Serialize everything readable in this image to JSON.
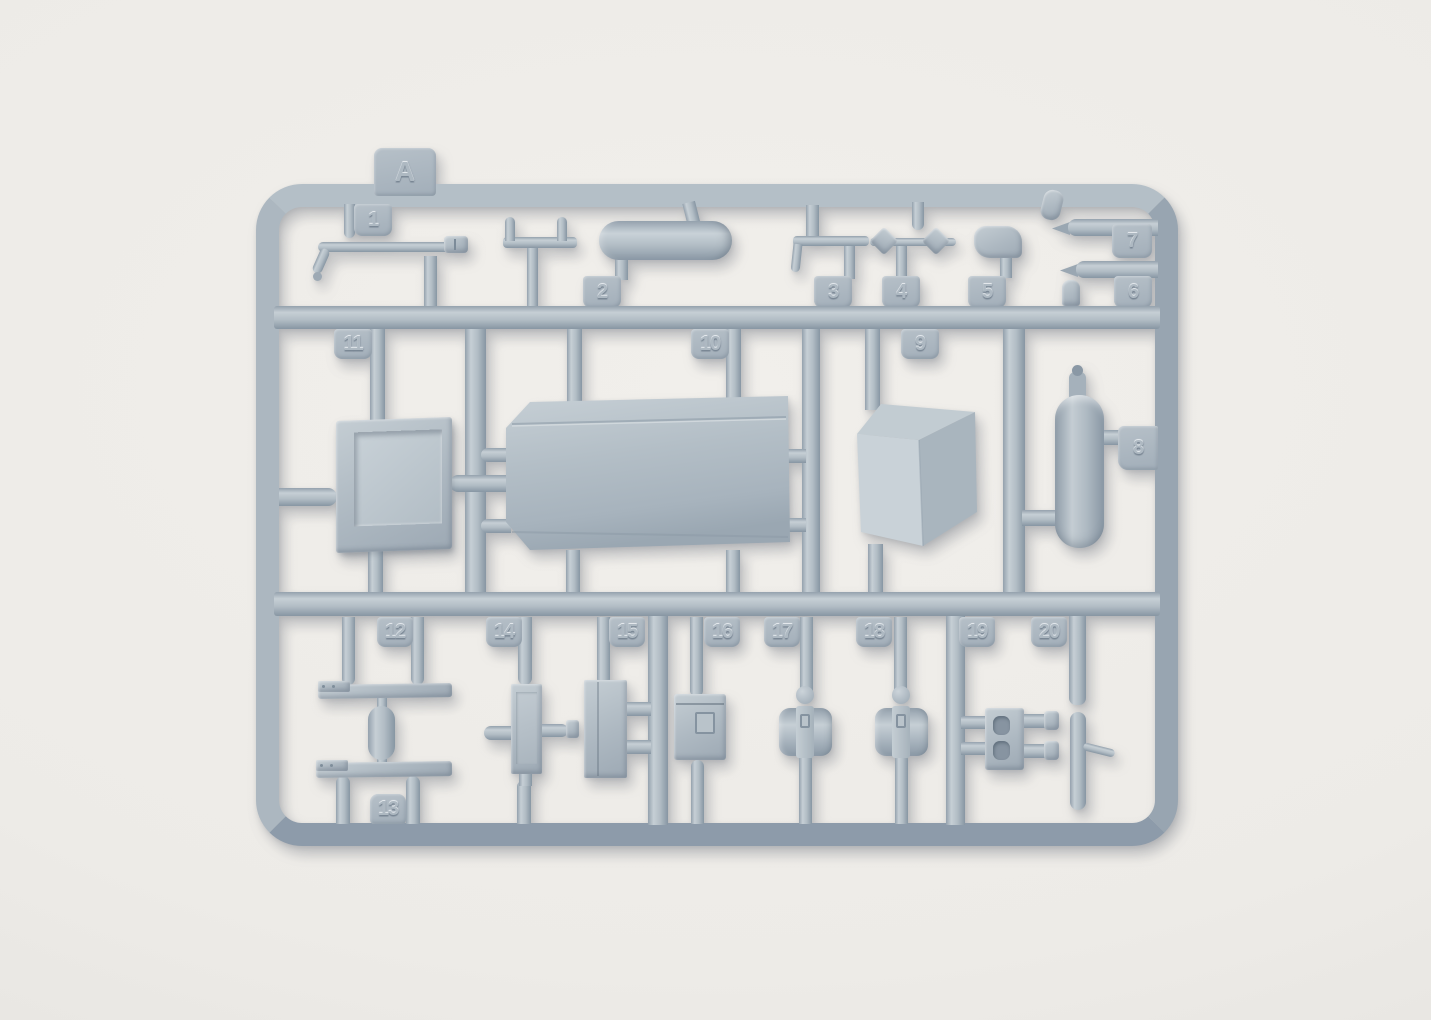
{
  "scene": {
    "description": "Photograph of a light grey injection-moulded plastic model-kit sprue (runner A) lying on a white surface",
    "background_color": "#edebe7",
    "plastic_color": "#aab4bd",
    "plastic_highlight": "#c6cfd5",
    "plastic_shadow": "#8796a3"
  },
  "sprue": {
    "letter_tab": "A",
    "tab_numbers": [
      "1",
      "2",
      "3",
      "4",
      "5",
      "6",
      "7",
      "8",
      "9",
      "10",
      "11",
      "12",
      "13",
      "14",
      "15",
      "16",
      "17",
      "18",
      "19",
      "20"
    ],
    "parts": [
      {
        "number": "1",
        "shape": "long tow-rod with hooked end"
      },
      {
        "number": "2",
        "shape": "horizontal cylinder tank"
      },
      {
        "number": "3",
        "shape": "L-shaped bracket"
      },
      {
        "number": "4",
        "shape": "axle with bow-tie paddles"
      },
      {
        "number": "5",
        "shape": "curved hook block"
      },
      {
        "number": "6",
        "shape": "small pointed barrel"
      },
      {
        "number": "7",
        "shape": "small pointed barrel"
      },
      {
        "number": "8",
        "shape": "vertical cylinder with filler cap"
      },
      {
        "number": "9",
        "shape": "faceted angular cover"
      },
      {
        "number": "10",
        "shape": "large bevelled flat panel"
      },
      {
        "number": "11",
        "shape": "rectangular open tray"
      },
      {
        "number": "12",
        "shape": "flat blade strip with end plate"
      },
      {
        "number": "13",
        "shape": "flat blade strip with end plate"
      },
      {
        "number": "14",
        "shape": "plate with side pegs"
      },
      {
        "number": "15",
        "shape": "rectangular block"
      },
      {
        "number": "16",
        "shape": "stowage box with latch"
      },
      {
        "number": "17",
        "shape": "strapped drum"
      },
      {
        "number": "18",
        "shape": "strapped drum"
      },
      {
        "number": "19",
        "shape": "slotted bracket with twin pegs"
      },
      {
        "number": "20",
        "shape": "small L-lever pin"
      }
    ]
  }
}
